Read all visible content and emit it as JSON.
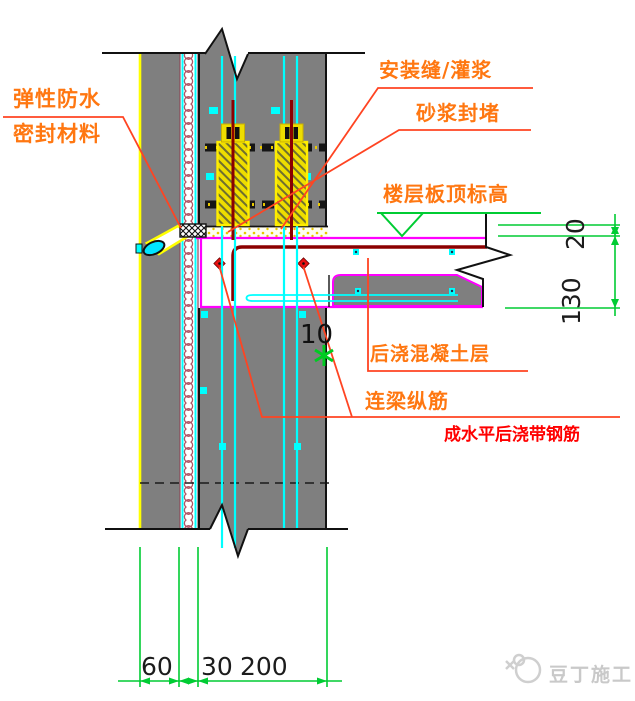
{
  "labels": {
    "elastic1": "弹性防水",
    "elastic2": "密封材料",
    "install_seam": "安装缝/灌浆",
    "mortar_seal": "砂浆封堵",
    "floor_elev": "楼层板顶标高",
    "post_cast": "后浇混凝土层",
    "beam_rebar": "连梁纵筋",
    "red_note": "成水平后浇带钢筋",
    "gap": "10"
  },
  "dimensions": {
    "d20": "20",
    "d130": "130",
    "d60": "60",
    "d30": "30",
    "d200": "200"
  },
  "watermark": {
    "text": "豆丁施工"
  },
  "colors": {
    "wall_gray": "#7f7f7f",
    "rebar_cyan": "#00ffff",
    "outline_magenta": "#ff00ff",
    "dim_green": "#00cc33",
    "label_orange": "#ff7711",
    "leader_red": "#ff4422",
    "note_red": "#ff0000",
    "sleeve_yellow": "#eedd00",
    "bar_maroon": "#8b0000",
    "face_yellow": "#ffff00"
  }
}
